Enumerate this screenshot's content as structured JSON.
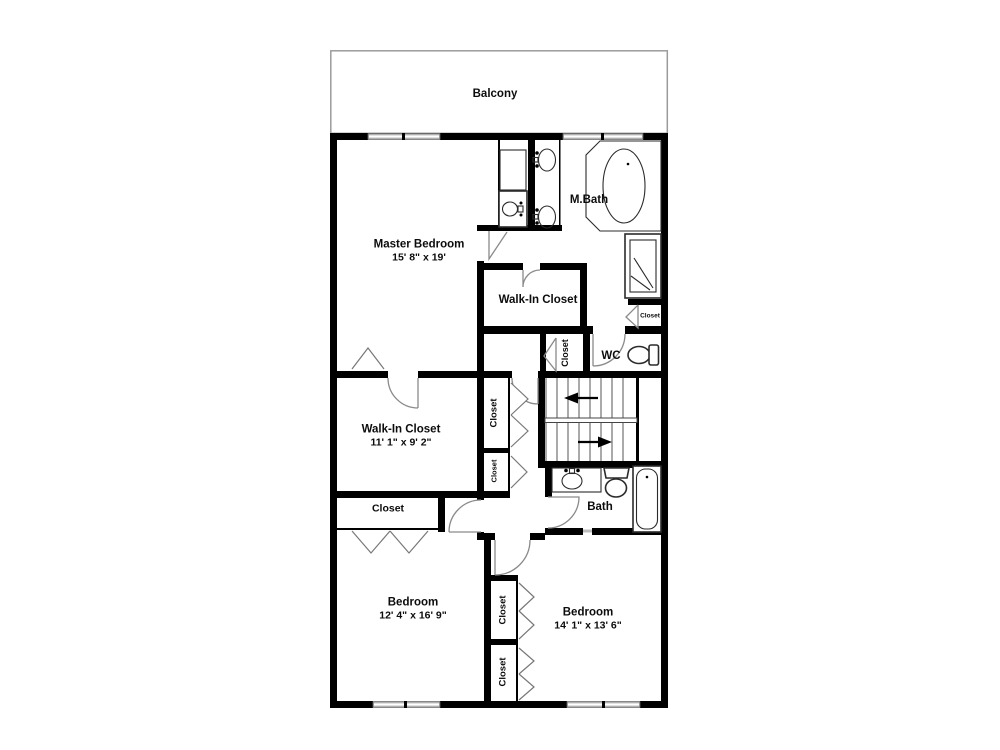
{
  "plan": {
    "balcony": {
      "label": "Balcony"
    },
    "master_bedroom": {
      "label": "Master Bedroom",
      "dims": "15' 8\" x 19'"
    },
    "master_bath": {
      "label": "M.Bath"
    },
    "walk_in_closet_upper": {
      "label": "Walk-In Closet"
    },
    "walk_in_closet_lower": {
      "label": "Walk-In Closet",
      "dims": "11' 1\" x 9' 2\""
    },
    "wc": {
      "label": "WC"
    },
    "bath": {
      "label": "Bath"
    },
    "bedroom_left": {
      "label": "Bedroom",
      "dims": "12' 4\" x 16' 9\""
    },
    "bedroom_right": {
      "label": "Bedroom",
      "dims": "14' 1\" x 13' 6\""
    },
    "closets": {
      "by_shower": "Closet",
      "by_wc": "Closet",
      "hall_upper": "Closet",
      "hall_lower": "Closet",
      "by_bedroom_left": "Closet",
      "bedroom_right_upper": "Closet",
      "bedroom_right_lower": "Closet"
    },
    "colors": {
      "wall": "#000000",
      "window_fill": "#d8d8d8",
      "door": "#8a8a8a",
      "fixture": "#2b2b2b",
      "balcony_border": "#9b9b9b",
      "background": "#ffffff"
    }
  }
}
